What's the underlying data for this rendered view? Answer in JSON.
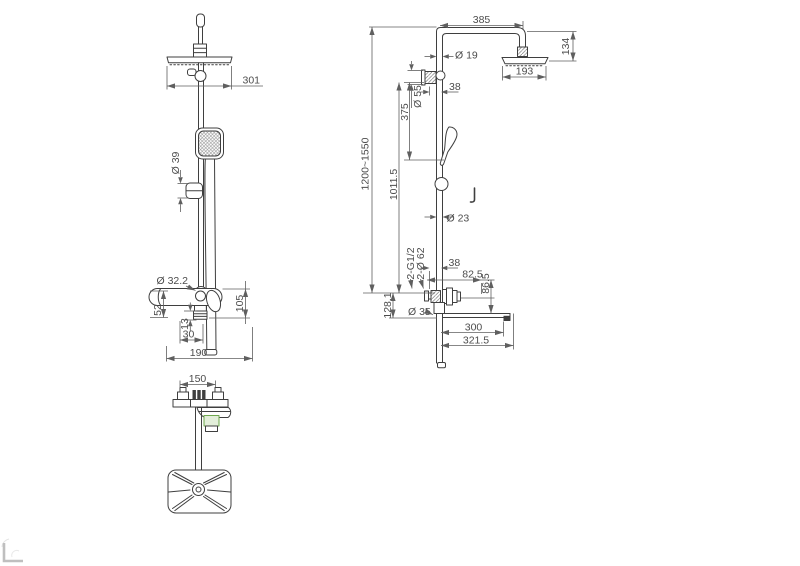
{
  "sheet": {
    "type": "technical-dimension-drawing",
    "product": "shower column"
  },
  "colors": {
    "background": "#ffffff",
    "line": "#3f3f3f",
    "dim_line": "#5f5f5f",
    "text": "#4c4c4c",
    "aerator_green": "#6fa84e",
    "aerator_green_fill": "#e3efda",
    "watermark_gray": "#b5b5b5"
  },
  "front_view": {
    "labels": {
      "head_width": "301",
      "handshower_dia": "Ø 39",
      "escutcheon_dia": "Ø 32.2",
      "body_height": "52",
      "aerator_height": "13",
      "spout_offset": "30",
      "spout_height": "105",
      "body_width": "190"
    }
  },
  "top_view": {
    "labels": {
      "width": "150"
    }
  },
  "side_view": {
    "labels": {
      "arm_length": "385",
      "head_drop": "134",
      "pipe_dia": "Ø 19",
      "head_dia": "193",
      "bracket_dia": "Ø 55",
      "bracket_offset": "38",
      "bracket_to_hook": "375",
      "rail_height": "1011.5",
      "total_height": "1200~1550",
      "rail_dia": "Ø 23",
      "inlet_thread": "2-G1/2",
      "inlet_escutcheon_dia": "2-Ø 62",
      "valve_offset": "38",
      "handle_reach": "82.5",
      "valve_height": "86.5",
      "inlet_to_shelf": "128.1",
      "spout_dia": "Ø 35",
      "shelf_length": "300",
      "shelf_overall": "321.5"
    }
  }
}
